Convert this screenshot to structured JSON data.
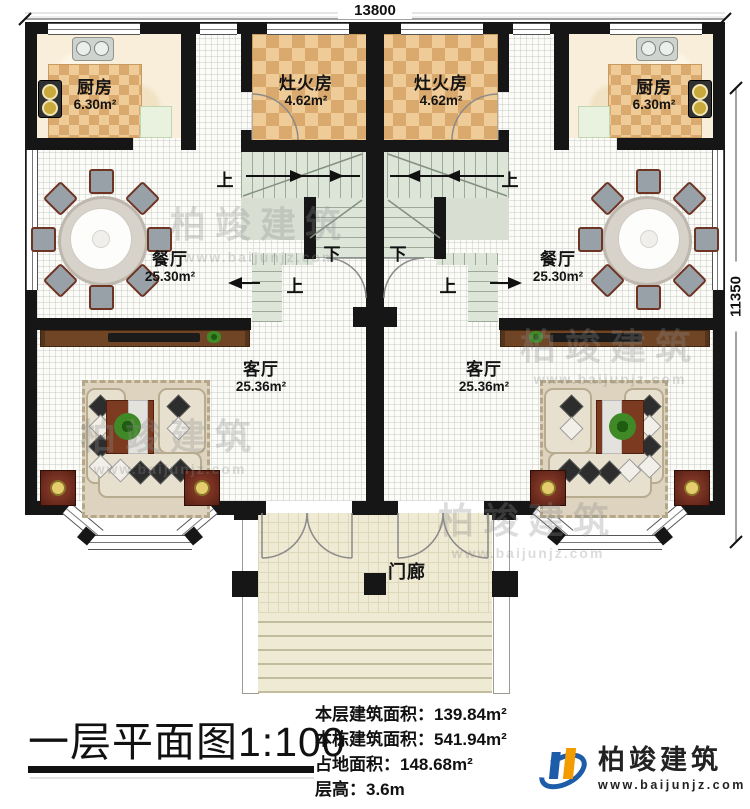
{
  "plan": {
    "dimensions": {
      "width_mm": "13800",
      "height_mm": "11350"
    },
    "rooms": {
      "kitchen_left": {
        "name": "厨房",
        "area": "6.30m²"
      },
      "kitchen_right": {
        "name": "厨房",
        "area": "6.30m²"
      },
      "stove_left": {
        "name": "灶火房",
        "area": "4.62m²"
      },
      "stove_right": {
        "name": "灶火房",
        "area": "4.62m²"
      },
      "dining_left": {
        "name": "餐厅",
        "area": "25.30m²"
      },
      "dining_right": {
        "name": "餐厅",
        "area": "25.30m²"
      },
      "living_left": {
        "name": "客厅",
        "area": "25.36m²"
      },
      "living_right": {
        "name": "客厅",
        "area": "25.36m²"
      },
      "porch": {
        "name": "门廊"
      }
    },
    "stairs": {
      "up": "上",
      "down": "下"
    }
  },
  "watermark": {
    "text": "柏竣建筑",
    "url": "www.baijunjz.com"
  },
  "title_block": {
    "title": "一层平面图",
    "scale": "1:100",
    "info": [
      {
        "label": "本层建筑面积：",
        "value": "139.84m²"
      },
      {
        "label": "本栋建筑面积：",
        "value": "541.94m²"
      },
      {
        "label": "占地面积：",
        "value": "148.68m²"
      },
      {
        "label": "层高：",
        "value": "3.6m"
      }
    ]
  },
  "logo": {
    "name": "柏竣建筑",
    "url": "www.baijunjz.com"
  }
}
